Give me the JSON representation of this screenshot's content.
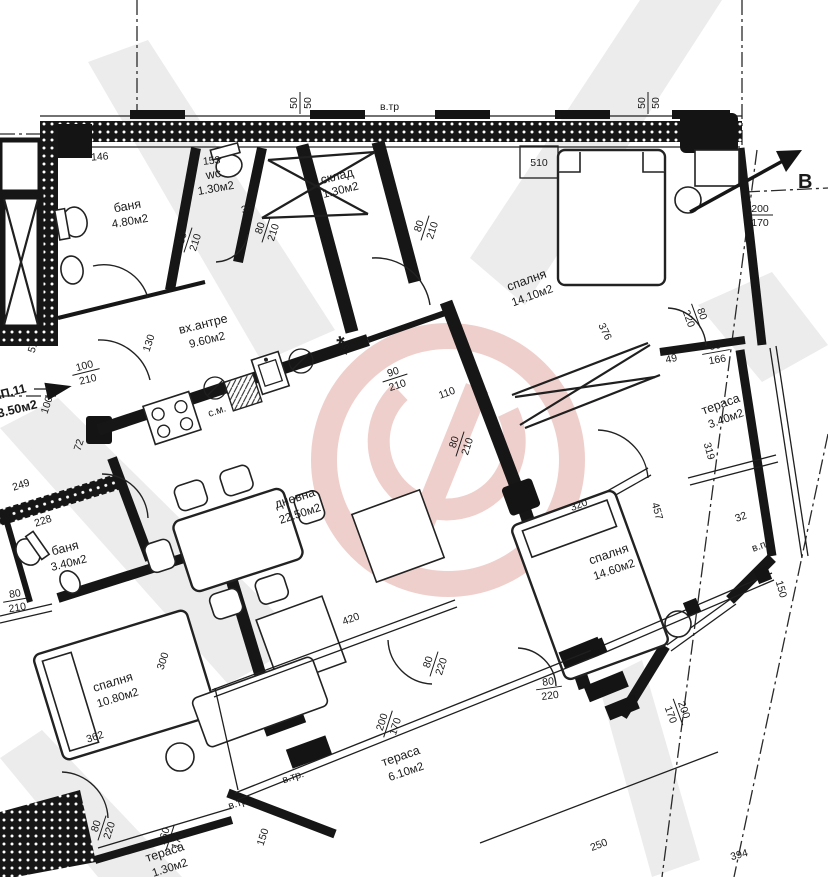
{
  "apartment": {
    "code": "АП.11",
    "area": "93.50м2"
  },
  "rooms": [
    {
      "name": "баня",
      "area": "4.80м2"
    },
    {
      "name": "wc",
      "area": "1.30м2"
    },
    {
      "name": "склад",
      "area": "1.30м2"
    },
    {
      "name": "спалня",
      "area": "14.10м2"
    },
    {
      "name": "вх.антре",
      "area": "9.60м2"
    },
    {
      "name": "тераса",
      "area": "3.40м2"
    },
    {
      "name": "дневна",
      "area": "22.50м2"
    },
    {
      "name": "спалня",
      "area": "14.60м2"
    },
    {
      "name": "баня",
      "area": "3.40м2"
    },
    {
      "name": "спалня",
      "area": "10.80м2"
    },
    {
      "name": "тераса",
      "area": "6.10м2"
    },
    {
      "name": "тераса",
      "area": "1.30м2"
    }
  ],
  "labels": {
    "vent_top": "в.тр",
    "vent1": "в.тр.",
    "vent2": "в.тр.",
    "vent_pr": "в.пр.",
    "section": "В",
    "washer": "с.м.",
    "star": "*"
  },
  "dims": {
    "v50a": {
      "num": "50",
      "den": "50"
    },
    "v50b": {
      "num": "50",
      "den": "50"
    },
    "n146": "146",
    "n153": "153",
    "n510": "510",
    "f200170a": {
      "num": "200",
      "den": "170"
    },
    "f200170b": {
      "num": "200",
      "den": "170"
    },
    "f200170c": {
      "num": "200",
      "den": "170"
    },
    "f80210a": {
      "num": "80",
      "den": "210"
    },
    "f80210b": {
      "num": "80",
      "den": "210"
    },
    "f80210c": {
      "num": "80",
      "den": "210"
    },
    "f90210": {
      "num": "90",
      "den": "210"
    },
    "f80210d": {
      "num": "80",
      "den": "210"
    },
    "f80210e": {
      "num": "80",
      "den": "210"
    },
    "f100210": {
      "num": "100",
      "den": "210"
    },
    "f80220a": {
      "num": "80",
      "den": "220"
    },
    "f80220b": {
      "num": "80",
      "den": "220"
    },
    "f80220c": {
      "num": "80",
      "den": "220"
    },
    "f80220d": {
      "num": "80",
      "den": "220"
    },
    "f160170": {
      "num": "160",
      "den": "170"
    },
    "f80166": {
      "num": "80",
      "den": "166"
    },
    "n38": "38",
    "n110": "110",
    "v100": "100",
    "v51": "51",
    "v72": "72",
    "v130": "130",
    "v75": "75",
    "n249": "249",
    "n228": "228",
    "v300": "300",
    "n362": "362",
    "n320": "320",
    "v457": "457",
    "v319": "319",
    "n32": "32",
    "v150a": "150",
    "v150b": "150",
    "n376": "376",
    "n420": "420",
    "n250": "250",
    "n394": "394",
    "n49": "49"
  }
}
